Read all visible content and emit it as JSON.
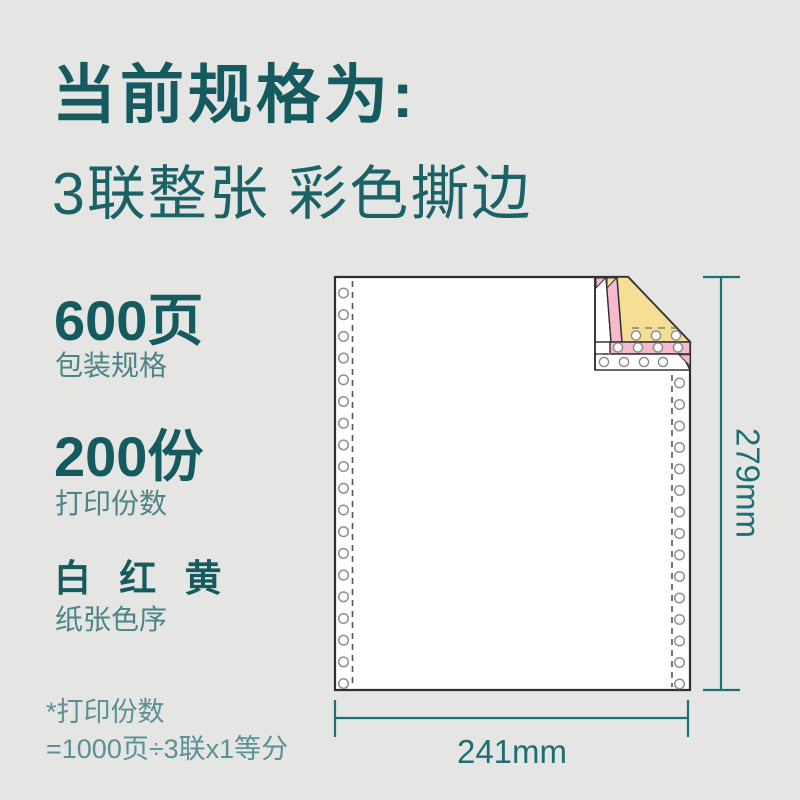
{
  "header": {
    "title": "当前规格为:",
    "subtitle": "3联整张 彩色撕边"
  },
  "specs": [
    {
      "value": "600页",
      "label": "包装规格"
    },
    {
      "value": "200份",
      "label": "打印份数"
    },
    {
      "value": "白 红 黄",
      "label": "纸张色序"
    }
  ],
  "footnote": {
    "line1": "*打印份数",
    "line2": "=1000页÷3联x1等分"
  },
  "diagram": {
    "width_label": "241mm",
    "height_label": "279mm",
    "plies": [
      "白",
      "红",
      "黄"
    ],
    "ply_colors": {
      "white": "#ffffff",
      "red": "#f7b9ce",
      "yellow": "#f5df94"
    }
  },
  "colors": {
    "accent_dark": "#155a5e",
    "accent_mid": "#4d8486",
    "footnote": "#5b9194",
    "dimension": "#1e6f74",
    "background": "#e5e5e4"
  }
}
